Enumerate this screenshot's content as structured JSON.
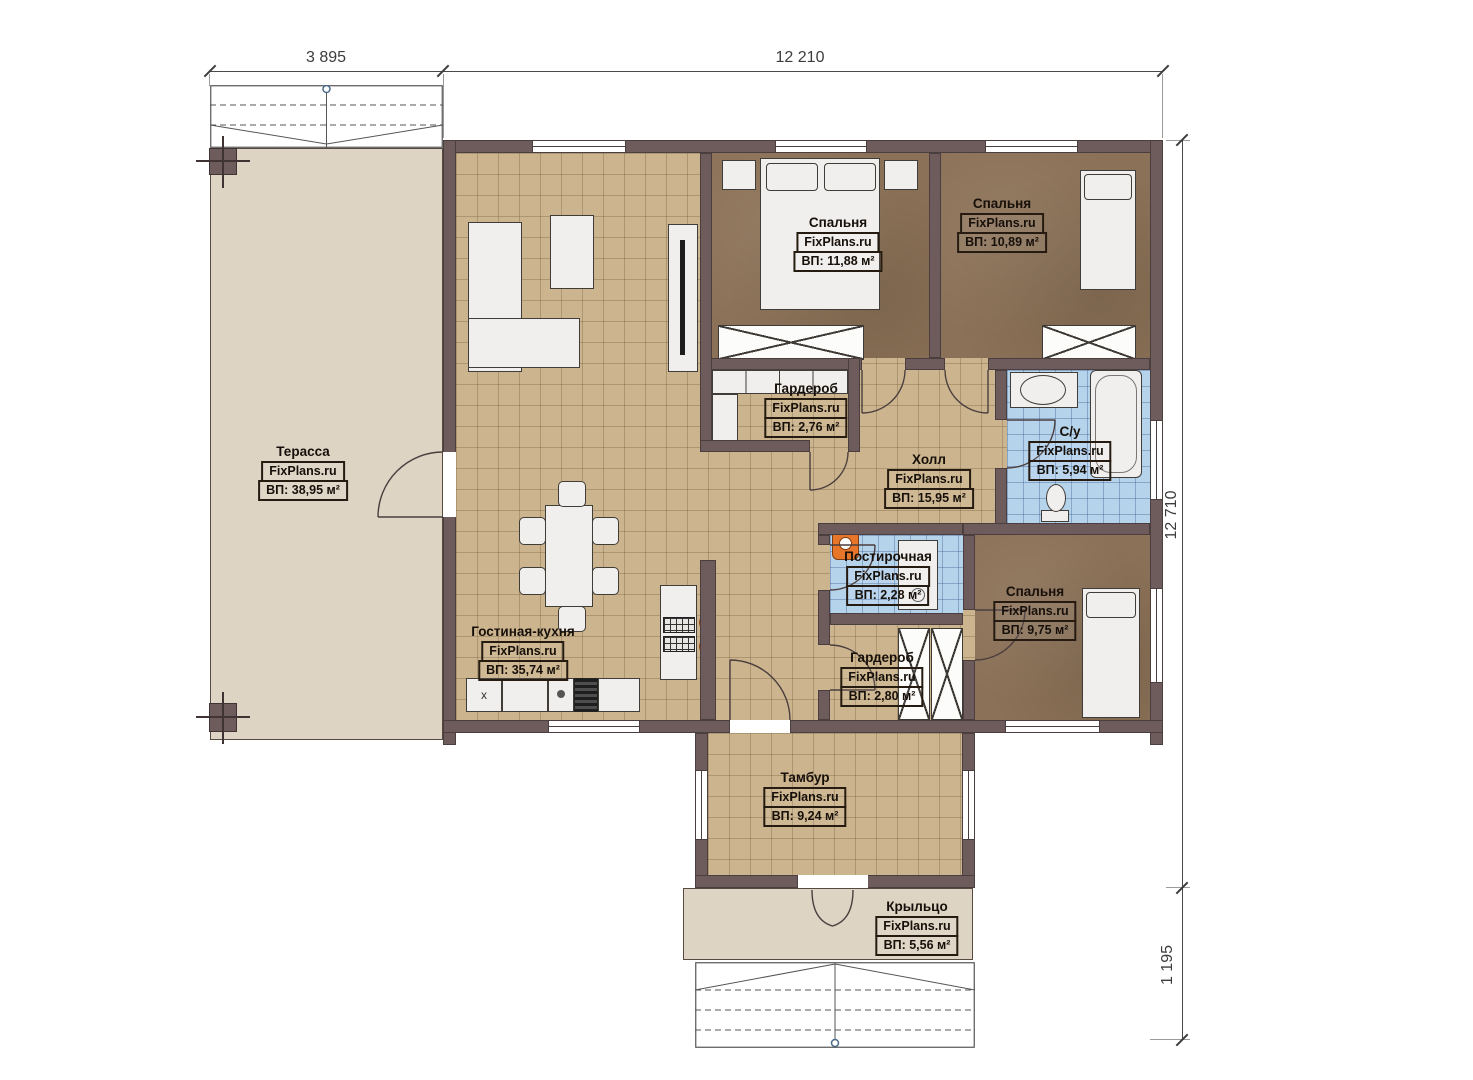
{
  "watermark": "FixPlans.ru",
  "dimensions": {
    "top_left": "3 895",
    "top_right": "12 210",
    "right": "12 710",
    "bottom_right": "1 195"
  },
  "rooms": [
    {
      "id": "terrace",
      "name": "Терасса",
      "area": "ВП: 38,95 м²"
    },
    {
      "id": "bedroom-1",
      "name": "Спальня",
      "area": "ВП: 11,88 м²"
    },
    {
      "id": "bedroom-2",
      "name": "Спальня",
      "area": "ВП: 10,89 м²"
    },
    {
      "id": "wardrobe-1",
      "name": "Гардероб",
      "area": "ВП: 2,76 м²"
    },
    {
      "id": "hall",
      "name": "Холл",
      "area": "ВП: 15,95 м²"
    },
    {
      "id": "bathroom",
      "name": "С/у",
      "area": "ВП: 5,94 м²"
    },
    {
      "id": "laundry",
      "name": "Постирочная",
      "area": "ВП: 2,28 м²"
    },
    {
      "id": "bedroom-3",
      "name": "Спальня",
      "area": "ВП: 9,75 м²"
    },
    {
      "id": "wardrobe-2",
      "name": "Гардероб",
      "area": "ВП: 2,80 м²"
    },
    {
      "id": "living-kitchen",
      "name": "Гостиная-кухня",
      "area": "ВП: 35,74 м²"
    },
    {
      "id": "vestibule",
      "name": "Тамбур",
      "area": "ВП: 9,24 м²"
    },
    {
      "id": "porch",
      "name": "Крыльцо",
      "area": "ВП: 5,56 м²"
    }
  ],
  "kitchen": {
    "appliance_label": "x"
  },
  "colors": {
    "wall": "#6e5c5c",
    "floor_tan": "#ccb58e",
    "floor_bedroom": "#8b7157",
    "floor_tile": "#b6d3ec",
    "terrace": "#ddd4c4",
    "accent_orange": "#e8762a"
  }
}
